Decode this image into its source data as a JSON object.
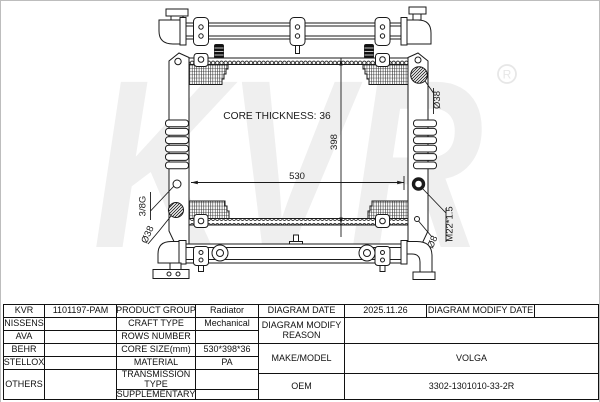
{
  "watermark": {
    "text": "KVR",
    "registered": "R"
  },
  "diagram": {
    "core_thickness_label": "CORE THICKNESS: 36",
    "dim_width": "530",
    "dim_height": "398",
    "label_inlet_diameter": "Ø38",
    "label_outlet_diameter": "Ø38",
    "label_drain_thread": "3/8G",
    "label_cap_thread": "M22*1.5",
    "label_small_hole": "Ø8"
  },
  "table": {
    "brands": [
      "KVR",
      "NISSENS",
      "AVA",
      "BEHR",
      "STELLOX",
      "OTHERS"
    ],
    "part_number": "1101197-PAM",
    "specs": [
      {
        "label": "PRODUCT GROUP",
        "value": "Radiator"
      },
      {
        "label": "CRAFT TYPE",
        "value": "Mechanical"
      },
      {
        "label": "ROWS NUMBER",
        "value": ""
      },
      {
        "label": "CORE SIZE(mm)",
        "value": "530*398*36"
      },
      {
        "label": "MATERIAL",
        "value": "PA"
      },
      {
        "label": "TRANSMISSION TYPE",
        "value": ""
      },
      {
        "label": "SUPPLEMENTARY",
        "value": ""
      }
    ],
    "right": {
      "diagram_date_label": "DIAGRAM DATE",
      "diagram_date": "2025.11.26",
      "diagram_modify_date_label": "DIAGRAM MODIFY DATE",
      "diagram_modify_date": "",
      "diagram_modify_reason_label": "DIAGRAM MODIFY REASON",
      "diagram_modify_reason": "",
      "make_model_label": "MAKE/MODEL",
      "make_model": "VOLGA",
      "oem_label": "OEM",
      "oem": "3302-1301010-33-2R"
    }
  }
}
